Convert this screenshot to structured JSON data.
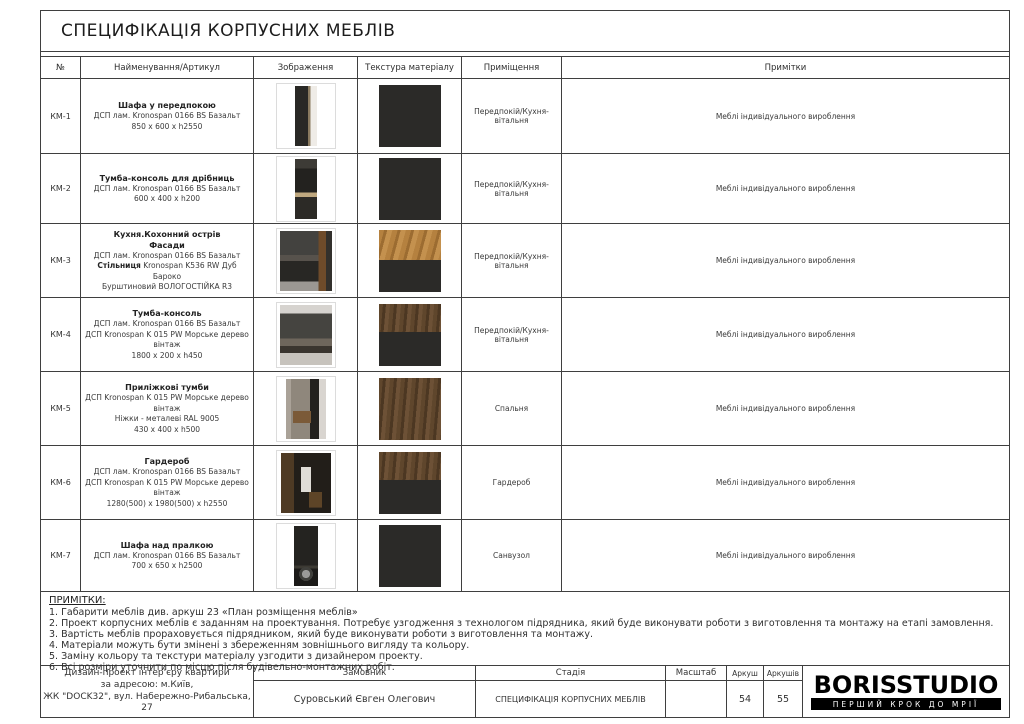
{
  "sheet": {
    "title": "СПЕЦИФІКАЦІЯ КОРПУСНИХ МЕБЛІВ"
  },
  "colors": {
    "border": "#3f3f3f",
    "panel_dark": "#2b2a28",
    "oak": "#b5813f",
    "walnut": "#5f462c",
    "logo_black": "#000000"
  },
  "table": {
    "headers": [
      "№",
      "Найменування/Артикул",
      "Зображення",
      "Текстура матеріалу",
      "Приміщення",
      "Примітки"
    ],
    "rows": [
      {
        "id": "КМ-1",
        "title_lines": [
          "Шафа у передпокою"
        ],
        "desc_lines": [
          "ДСП лам. Kronospan 0166 BS Базальт",
          "850 x 600 x h2550"
        ],
        "photo": "hallway-wardrobe",
        "texture": "dark-full",
        "room": "Передпокій/Кухня-вітальня",
        "note": "Меблі індивідуального вироблення"
      },
      {
        "id": "КМ-2",
        "title_lines": [
          "Тумба-консоль для дрібниць"
        ],
        "desc_lines": [
          "ДСП лам. Kronospan 0166 BS Базальт",
          "600 x 400 x h200"
        ],
        "photo": "console",
        "texture": "dark-full",
        "room": "Передпокій/Кухня-вітальня",
        "note": "Меблі індивідуального вироблення"
      },
      {
        "id": "КМ-3",
        "title_lines": [
          "Кухня.Кохонний острів",
          "Фасади"
        ],
        "desc_lines": [
          "ДСП лам. Kronospan 0166 BS Базальт",
          {
            "bold": "Стільниця",
            "text": " Kronospan K536 RW Дуб Бароко"
          },
          "Бурштиновий ВОЛОГОСТІЙКА R3"
        ],
        "photo": "kitchen-island",
        "texture": "oak-dark",
        "room": "Передпокій/Кухня-вітальня",
        "note": "Меблі індивідуального вироблення"
      },
      {
        "id": "КМ-4",
        "title_lines": [
          "Тумба-консоль"
        ],
        "desc_lines": [
          "ДСП лам. Kronospan 0166 BS Базальт",
          "ДСП Kronospan K 015 PW Морське дерево вінтаж",
          "1800 x 200 x h450"
        ],
        "photo": "tv-console",
        "texture": "walnut-dark",
        "room": "Передпокій/Кухня-вітальня",
        "note": "Меблі індивідуального вироблення"
      },
      {
        "id": "КМ-5",
        "title_lines": [
          "Приліжкові тумби"
        ],
        "desc_lines": [
          "ДСП Kronospan K 015 PW Морське дерево вінтаж",
          "Ніжки - металеві RAL 9005",
          "430 x 400 x h500"
        ],
        "photo": "bedside-table",
        "texture": "walnut-full",
        "room": "Спальня",
        "note": "Меблі індивідуального вироблення"
      },
      {
        "id": "КМ-6",
        "title_lines": [
          "Гардероб"
        ],
        "desc_lines": [
          "ДСП лам. Kronospan 0166 BS Базальт",
          "ДСП Kronospan K 015 PW Морське дерево вінтаж",
          "1280(500) x 1980(500) x h2550"
        ],
        "photo": "wardrobe-interior",
        "texture": "walnut-dark",
        "room": "Гардероб",
        "note": "Меблі індивідуального вироблення"
      },
      {
        "id": "КМ-7",
        "title_lines": [
          "Шафа над пралкою"
        ],
        "desc_lines": [
          "ДСП лам. Kronospan 0166 BS Базальт",
          "700 x 650 x h2500"
        ],
        "photo": "laundry-cabinet",
        "texture": "dark-full",
        "room": "Санвузол",
        "note": "Меблі індивідуального вироблення"
      }
    ]
  },
  "notes": {
    "heading": "ПРИМІТКИ:",
    "items": [
      "1. Габарити меблів див. аркуш 23 «План розміщення меблів»",
      "2. Проект корпусних меблів є заданням на проектування. Потребує узгодження з технологом підрядника, який буде виконувати роботи з виготовлення та монтажу на етапі замовлення.",
      "3. Вартість меблів прораховується підрядником, який буде виконувати роботи з виготовлення та монтажу.",
      "4. Матеріали можуть бути змінені з збереженням зовнішнього вигляду та кольору.",
      "5. Заміну кольору та текстури матеріалу узгодити з дизайнером проекту.",
      "6. Всі розміри уточнити по місцю після будівельно-монтажних робіт."
    ]
  },
  "titleblock": {
    "project_lines": [
      "Дизайн-проект інтер'єру квартири",
      "за адресою: м.Київ,",
      "ЖК \"DOCK32\", вул. Набережно-Рибальська, 27"
    ],
    "customer_label": "Замовник",
    "customer_value": "Суровський Євген Олегович",
    "stage_label": "Стадія",
    "stage_value": "СПЕЦИФІКАЦІЯ КОРПУСНИХ МЕБЛІВ",
    "scale_label": "Масштаб",
    "scale_value": "",
    "sheet_label": "Аркуш",
    "sheet_value": "54",
    "sheets_label": "Аркушів",
    "sheets_value": "55",
    "logo_text": "BORISSTUDIO",
    "logo_tagline": "ПЕРШИЙ КРОК ДО МРІЇ"
  }
}
